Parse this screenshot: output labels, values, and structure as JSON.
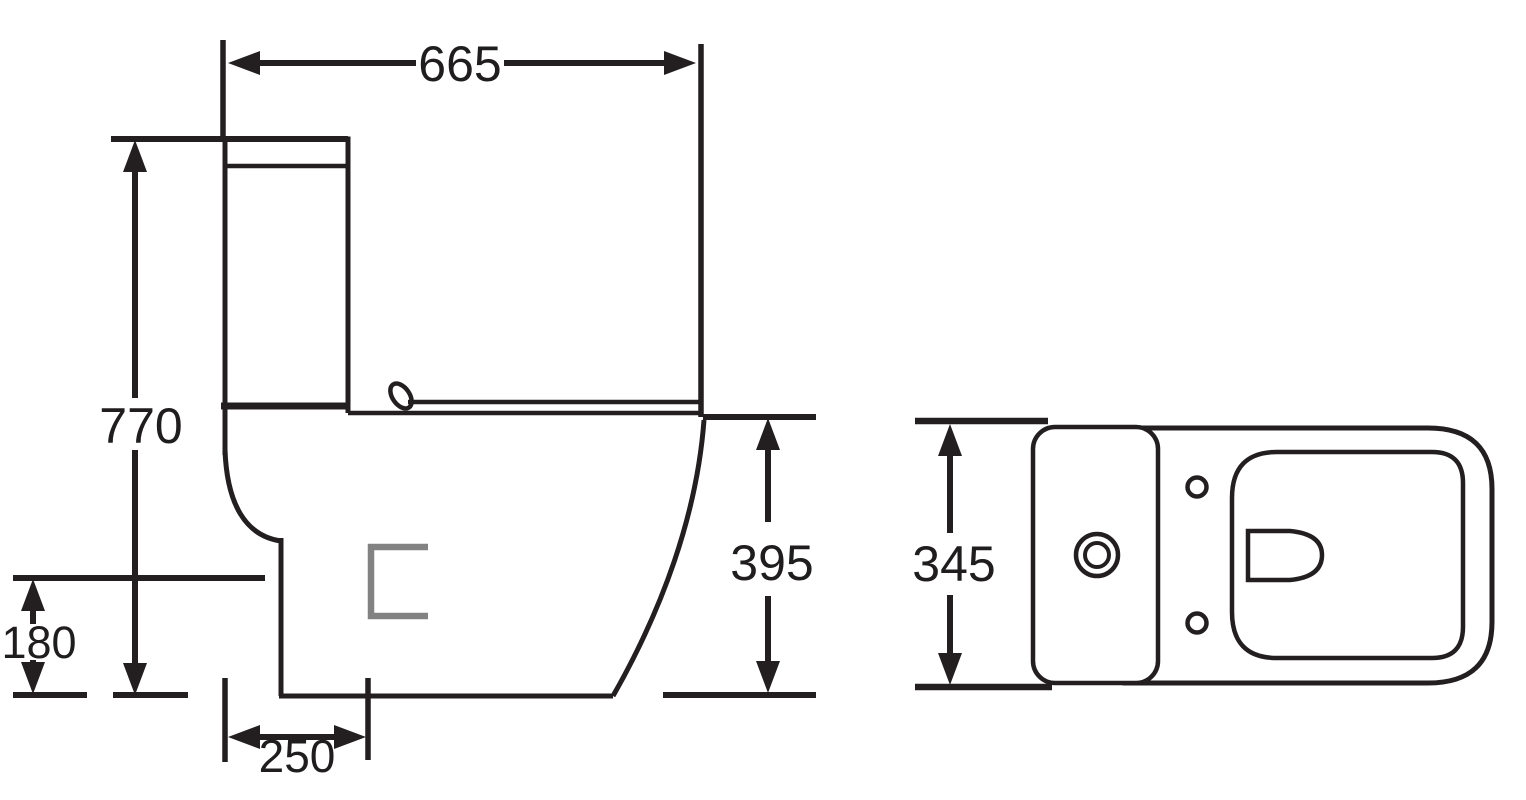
{
  "drawing": {
    "subject": "Close-coupled toilet (WC) technical dimension drawing, side elevation and top plan",
    "views": {
      "side": {
        "name": "side-elevation",
        "overall_depth": "665",
        "overall_height": "770",
        "outlet_height": "180",
        "outlet_setback": "250",
        "bowl_rim_height": "395"
      },
      "top": {
        "name": "top-plan",
        "overall_width": "345"
      }
    },
    "style": {
      "line_color": "#231f20",
      "label_color": "#1f1d1e",
      "outlet_mark_color": "#828282",
      "background_color": "#ffffff"
    }
  }
}
